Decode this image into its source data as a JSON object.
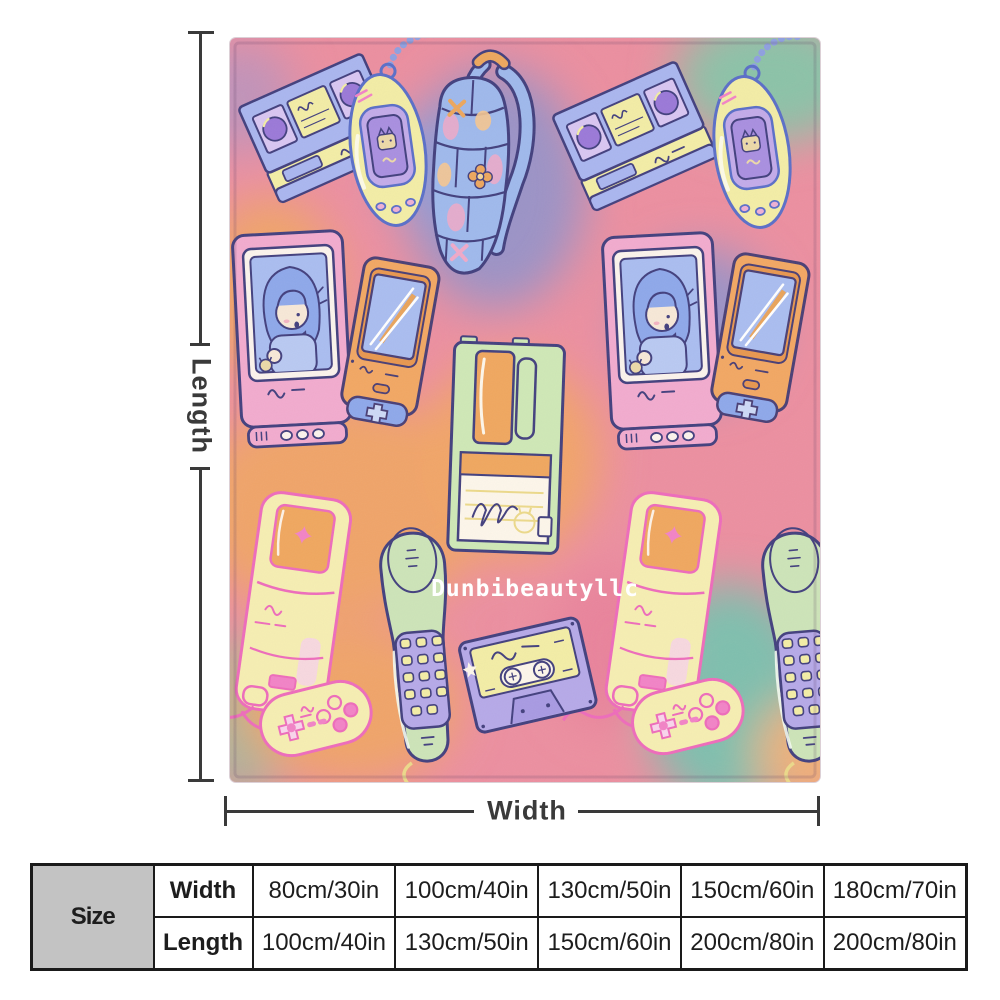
{
  "preview": {
    "watermark": "Dunbibeautyllc",
    "dimension_labels": {
      "length": "Length",
      "width": "Width"
    },
    "illustrations": [
      "vhs-tape",
      "tamagotchi",
      "backpack",
      "crt-tv",
      "game-boy",
      "floppy-disk",
      "toy-console",
      "cordless-phone",
      "cassette-tape",
      "game-controller"
    ]
  },
  "size_table": {
    "corner_label": "Size",
    "rows": [
      {
        "label": "Width",
        "values": [
          "80cm/30in",
          "100cm/40in",
          "130cm/50in",
          "150cm/60in",
          "180cm/70in"
        ]
      },
      {
        "label": "Length",
        "values": [
          "100cm/40in",
          "130cm/50in",
          "150cm/60in",
          "200cm/80in",
          "200cm/80in"
        ]
      }
    ]
  },
  "colors": {
    "page_bg": "#ffffff",
    "dimension_line": "#3a3a3a",
    "table_border": "#1a1a1a",
    "table_corner_bg": "#c3c3c3",
    "blanket_base_pink": "#ec8fa0",
    "tie_dye_orange": "#f0a469",
    "tie_dye_purple": "#9b93c6",
    "tie_dye_teal": "#7fbfae",
    "outline_navy": "#43407e",
    "outline_pink": "#ee6cbb",
    "cream_yellow": "#f5eeae",
    "watermark_white": "#ffffff"
  }
}
